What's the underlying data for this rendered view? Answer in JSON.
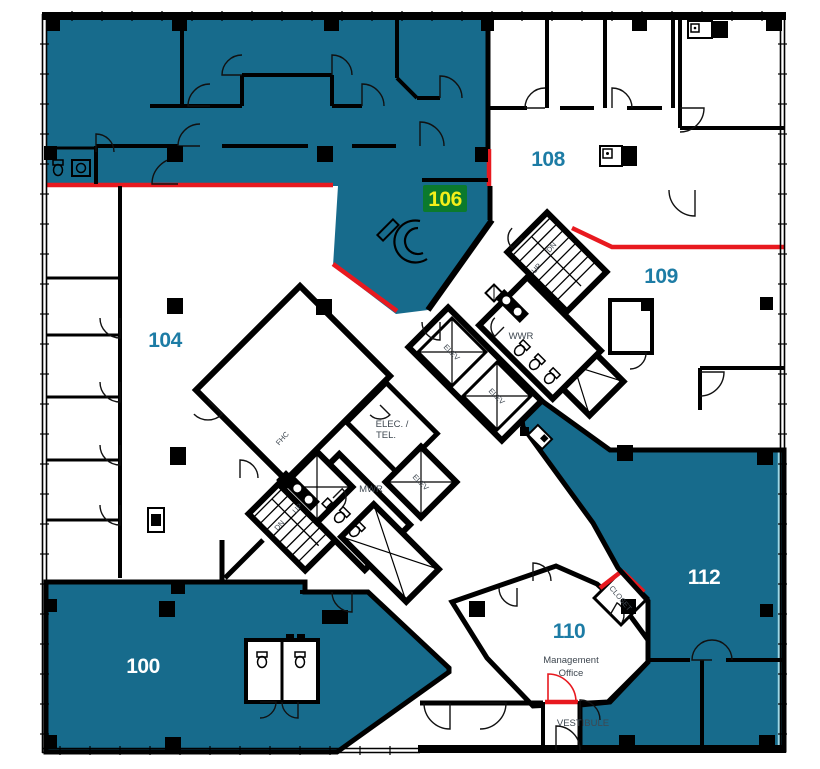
{
  "palette": {
    "suite_teal": "#176b8c",
    "wall_black": "#000000",
    "demising_red": "#e8191f",
    "glass_cyan": "#9fd8e6",
    "badge_green": "#0b7a2d",
    "badge_yellow": "#f3ef1a",
    "label_teal": "#1d7ca5",
    "label_white": "#ffffff",
    "room_label_gray": "#3e4750"
  },
  "suites": {
    "s100": {
      "number": "100",
      "status": "highlighted"
    },
    "s104": {
      "number": "104",
      "status": "unhighlighted"
    },
    "s106": {
      "number": "106",
      "status": "selected-badge"
    },
    "s108": {
      "number": "108",
      "status": "unhighlighted"
    },
    "s109": {
      "number": "109",
      "status": "unhighlighted"
    },
    "s110": {
      "number": "110",
      "status": "unhighlighted",
      "sublabel_line1": "Management",
      "sublabel_line2": "Office"
    },
    "s112": {
      "number": "112",
      "status": "highlighted"
    }
  },
  "core": {
    "elevator_label": "ELEV",
    "stair_up": "UP",
    "stair_down": "DN",
    "womens_washroom": "WWR",
    "mens_washroom": "MWR",
    "electrical_line1": "ELEC. /",
    "electrical_line2": "TEL.",
    "fire_hose_cabinet": "FHC",
    "closet": "CLOSET",
    "vestibule": "VESTIBULE"
  }
}
